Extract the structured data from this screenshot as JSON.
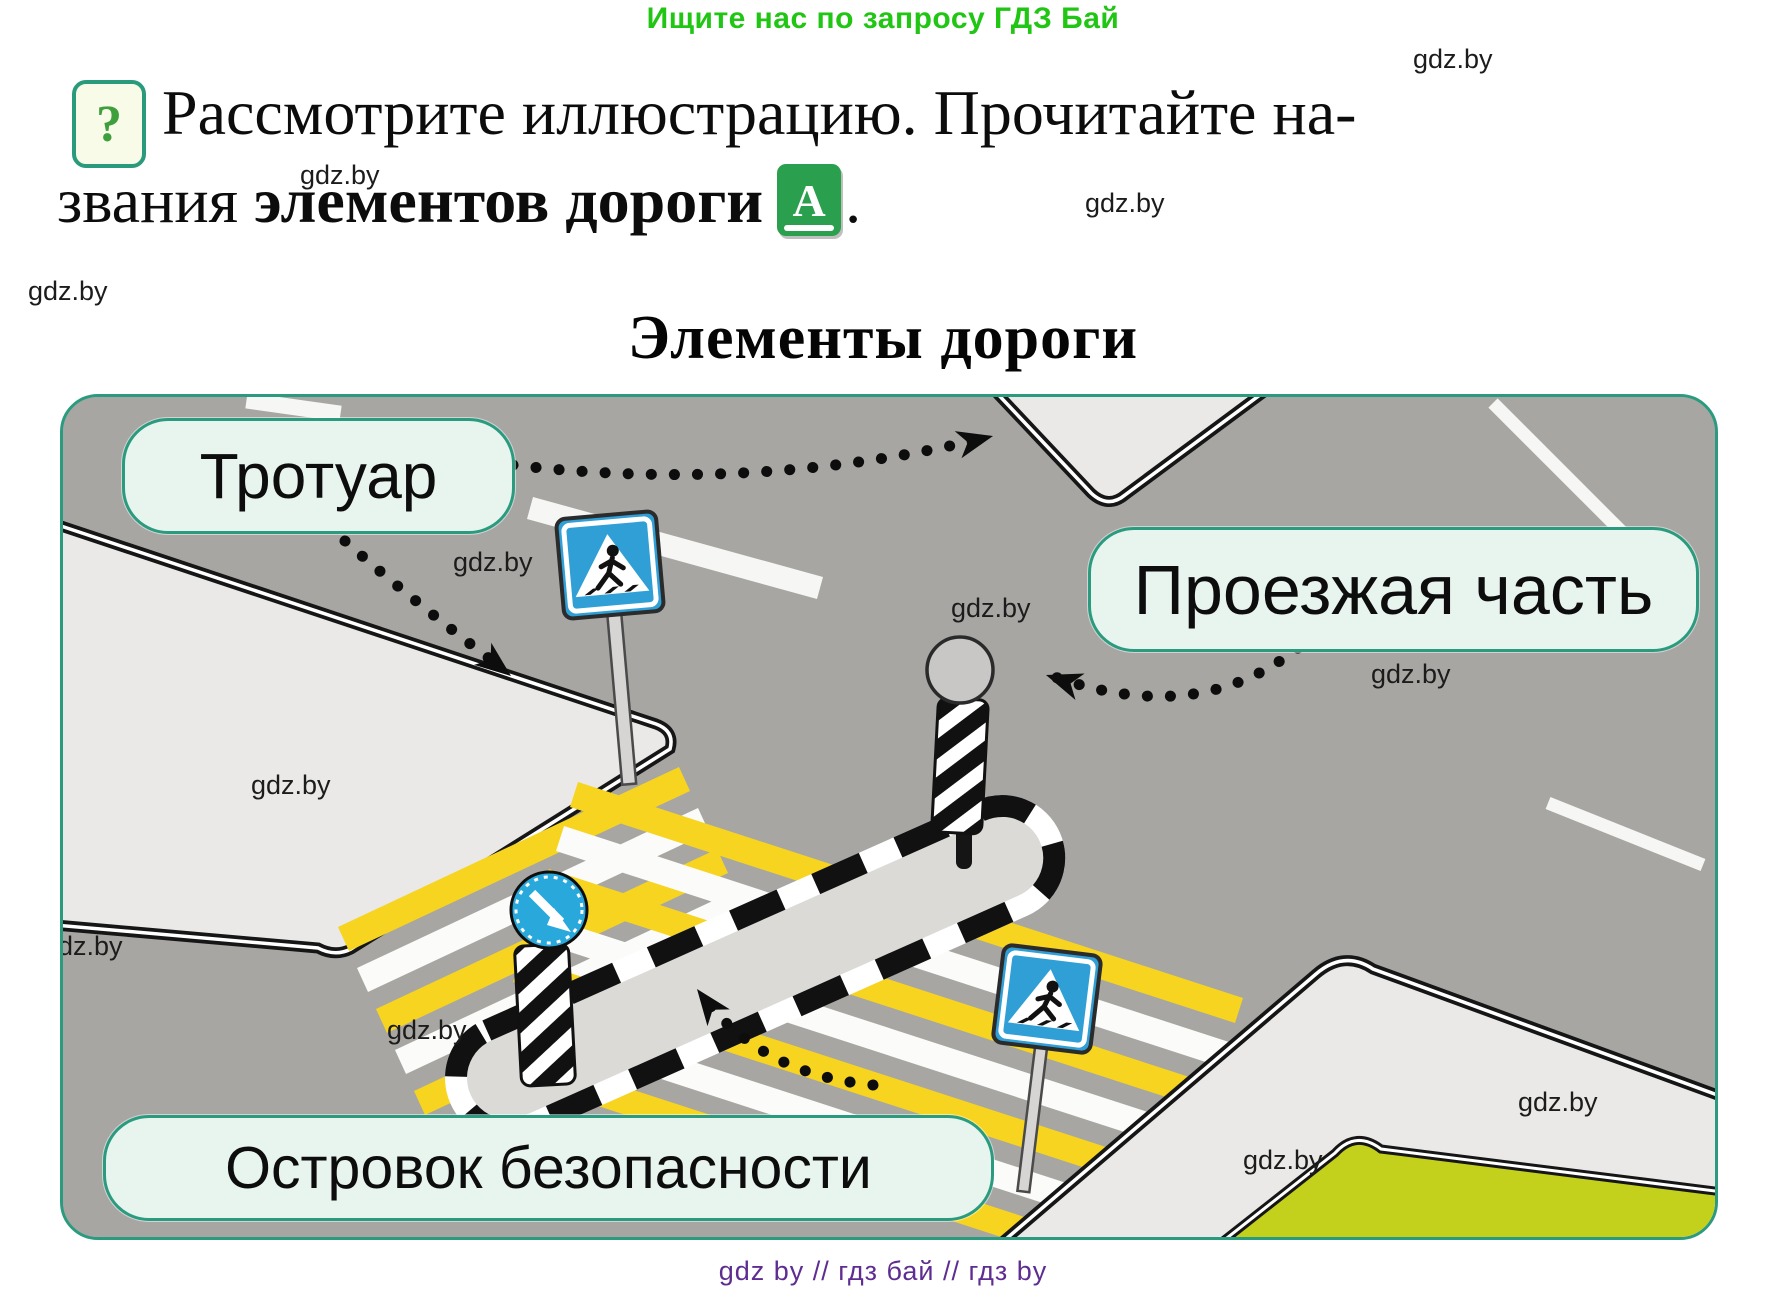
{
  "promo": {
    "text": "Ищите нас по запросу ГДЗ Бай"
  },
  "watermark": {
    "text": "gdz.by"
  },
  "task": {
    "question_mark": "?",
    "line1": "Рассмотрите иллюстрацию. Прочитайте на-",
    "line2_start": "звания ",
    "line2_bold": "элементов дороги",
    "dictionary_letter": "А",
    "line2_end": "."
  },
  "figure": {
    "title": "Элементы дороги",
    "labels": {
      "sidewalk": "Тротуар",
      "roadway": "Проезжая часть",
      "island": "Островок безопасности"
    }
  },
  "footer": {
    "text": "gdz by  //  гдз бай  //  гдз by"
  },
  "colors": {
    "promo_green": "#21c614",
    "accent_teal": "#2b9b80",
    "label_background": "#e8f4ee",
    "book_icon_green": "#2aa04e",
    "question_green": "#3f9f3c",
    "road_gray": "#a8a6a3",
    "sidewalk_gray": "#eae9e7",
    "grass_green": "#c3d01c",
    "zebra_yellow": "#f6d41f",
    "sign_blue": "#2f9fd6",
    "footer_purple": "#5f2d91"
  }
}
